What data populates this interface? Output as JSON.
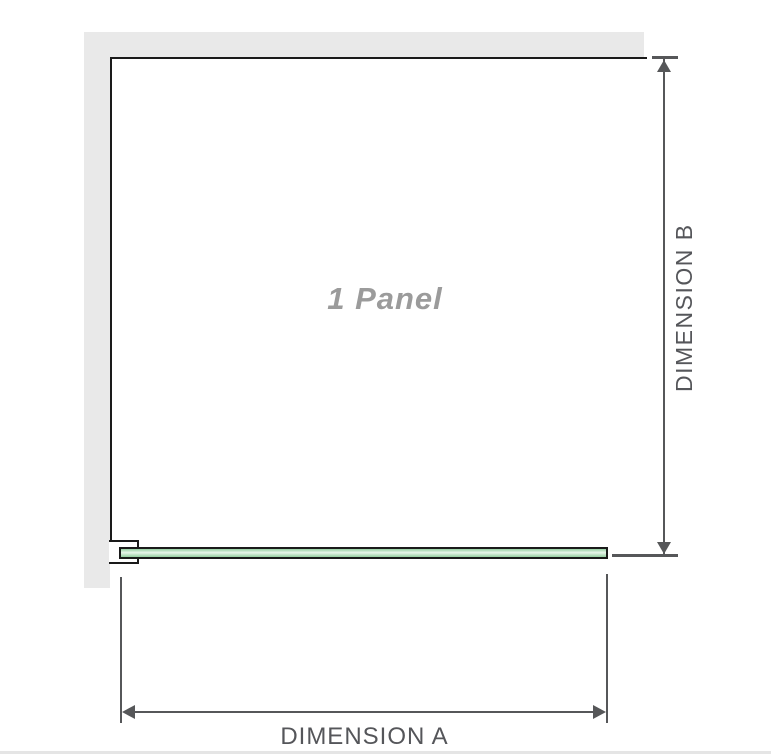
{
  "diagram": {
    "title": "1 panel shower screen dimension diagram",
    "panel_label": "1 Panel",
    "dimension_a_label": "DIMENSION A",
    "dimension_b_label": "DIMENSION B"
  },
  "colors": {
    "wall": "#e9e9e9",
    "outline": "#1a1a1a",
    "glass_green": "#94cfa0",
    "glass_highlight": "#e9f6eb",
    "dimension_line": "#565759",
    "label_text": "#55565a",
    "panel_label_text": "#9b9b9b",
    "bottom_divider": "#e5e5e5"
  }
}
